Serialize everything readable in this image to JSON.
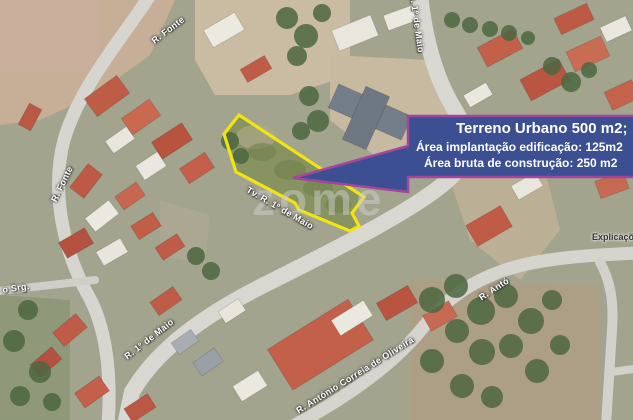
{
  "callout": {
    "title": "Terreno Urbano 500 m2;",
    "line2": "Área implantação edificação: 125m2",
    "line3": "Área bruta de construção: 250 m2",
    "fill_color": "#3b4f92",
    "border_color": "#a2469d",
    "text_color": "#ffffff"
  },
  "map": {
    "watermark": "zome",
    "plot_outline_color": "#f2e313",
    "street_labels": [
      {
        "text": "R. Fonte"
      },
      {
        "text": "R. Fonte"
      },
      {
        "text": "R. 1º de Maio"
      },
      {
        "text": "Tv. R. 1º de Maio"
      },
      {
        "text": "R. 1º de Maio"
      },
      {
        "text": "R. António Correia de Oliveira"
      },
      {
        "text": "R. Antó"
      },
      {
        "text": "o Srg."
      }
    ],
    "place_label": "Explicaçõ"
  }
}
